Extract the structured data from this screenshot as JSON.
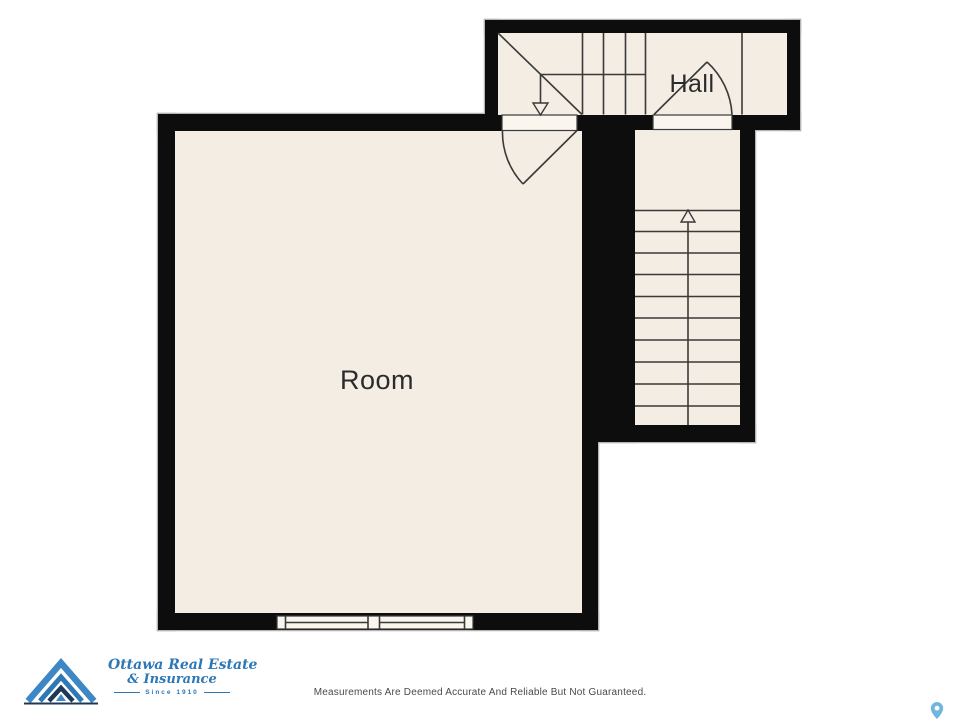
{
  "plan": {
    "room_label": "Room",
    "hall_label": "Hall"
  },
  "footer": {
    "disclaimer": "Measurements Are Deemed Accurate And Reliable But Not Guaranteed."
  },
  "logo": {
    "name_line1": "Ottawa Real Estate",
    "name_line2": "& Insurance",
    "tagline": "Since 1910"
  },
  "icons": {
    "stairs_up_arrow": "up-arrow-icon",
    "stairs_down_arrow": "down-arrow-icon",
    "map_pin": "location-pin-icon",
    "logo_mark": "mountain-chevrons-icon"
  },
  "colors": {
    "wall": "#0d0d0d",
    "wall_outline": "#b5b5b5",
    "floor": "#f3ede3",
    "opening": "#faf6ee",
    "line": "#3a3a3a",
    "label": "#2b2b2b",
    "disclaimer": "#4a4a4a",
    "logo_blue": "#2d78b5",
    "logo_light_blue": "#3c87c4",
    "logo_navy": "#1c3a58",
    "pin_blue": "#72b6dd"
  }
}
